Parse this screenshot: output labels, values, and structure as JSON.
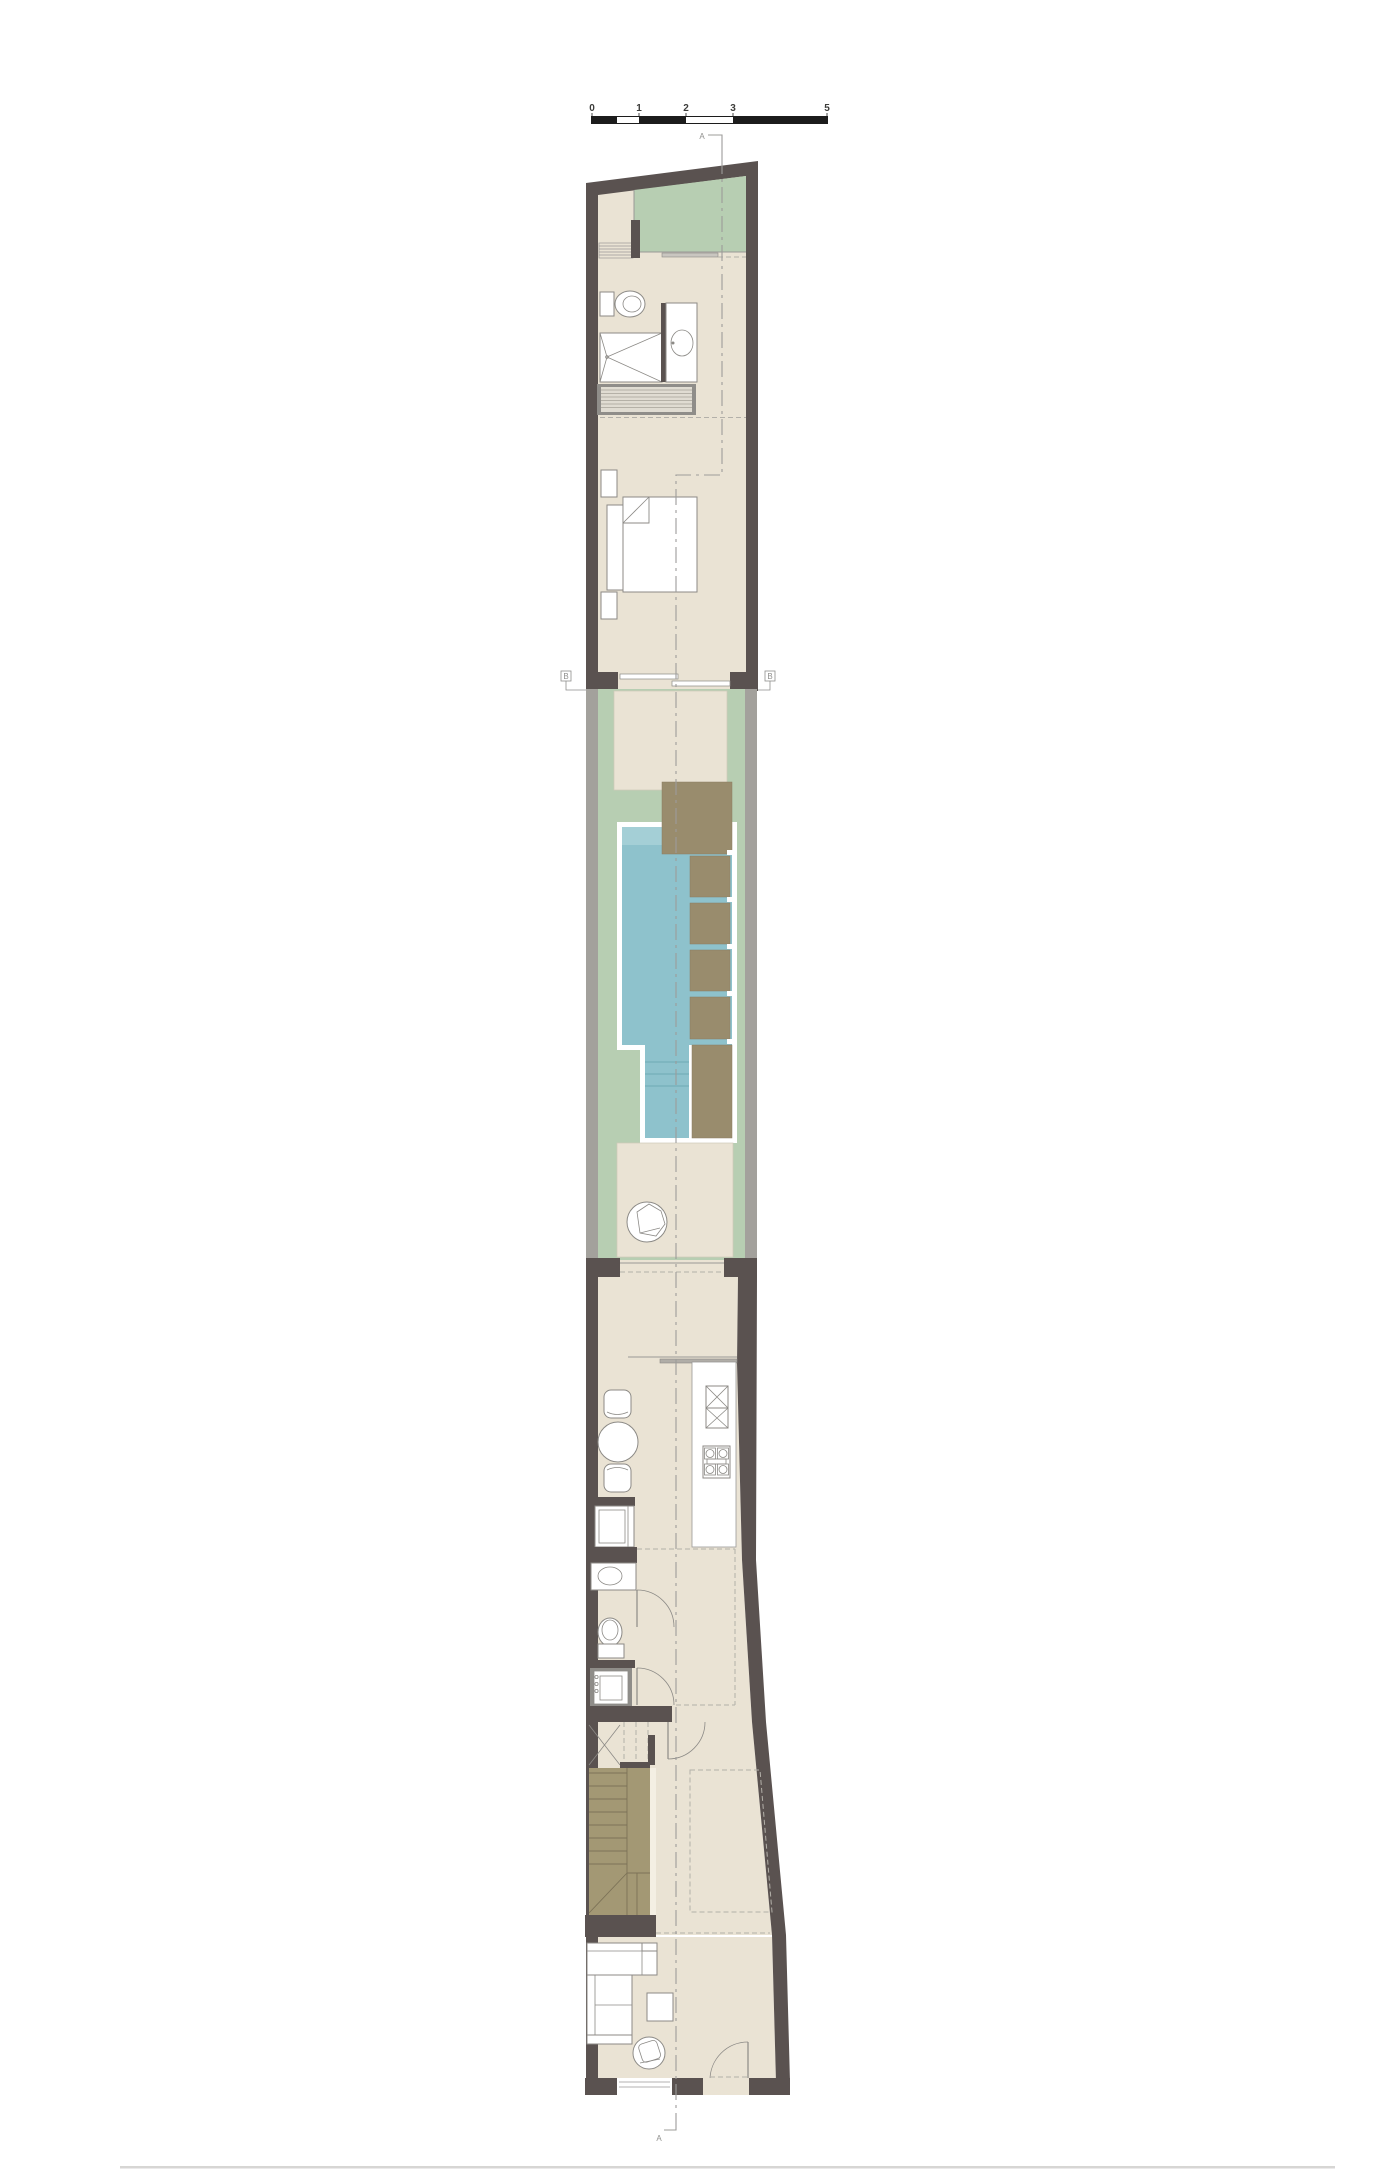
{
  "scale_bar": {
    "labels": [
      "0",
      "1",
      "2",
      "3",
      "5"
    ]
  },
  "section_markers": {
    "top": "A",
    "bottom": "A",
    "left": "B",
    "right": "B"
  },
  "colors": {
    "wall_dark": "#5a5250",
    "wall_light": "#a3a19c",
    "floor": "#eae3d4",
    "terrace_green": "#b7ceb2",
    "pool_water": "#8ec2cc",
    "pool_shallow": "#a4cfd6",
    "pool_step_line": "#6fa9b4",
    "deck_wood": "#998c6d",
    "stair_wood": "#a39874",
    "stair_line": "#7c7257",
    "furniture_outline": "#8c8a86",
    "closet_frame": "#8f8d89",
    "closet_fill": "#e0dcd2",
    "closet_stripe": "#b5b1a7",
    "dash_line": "#b3b0a9",
    "section_line": "#9d9c9a",
    "scale_bar_black": "#1c1c1c",
    "label_text": "#3c3c3a",
    "marker_text": "#8f8f8d",
    "shadow_line": "#b7b5b1"
  }
}
